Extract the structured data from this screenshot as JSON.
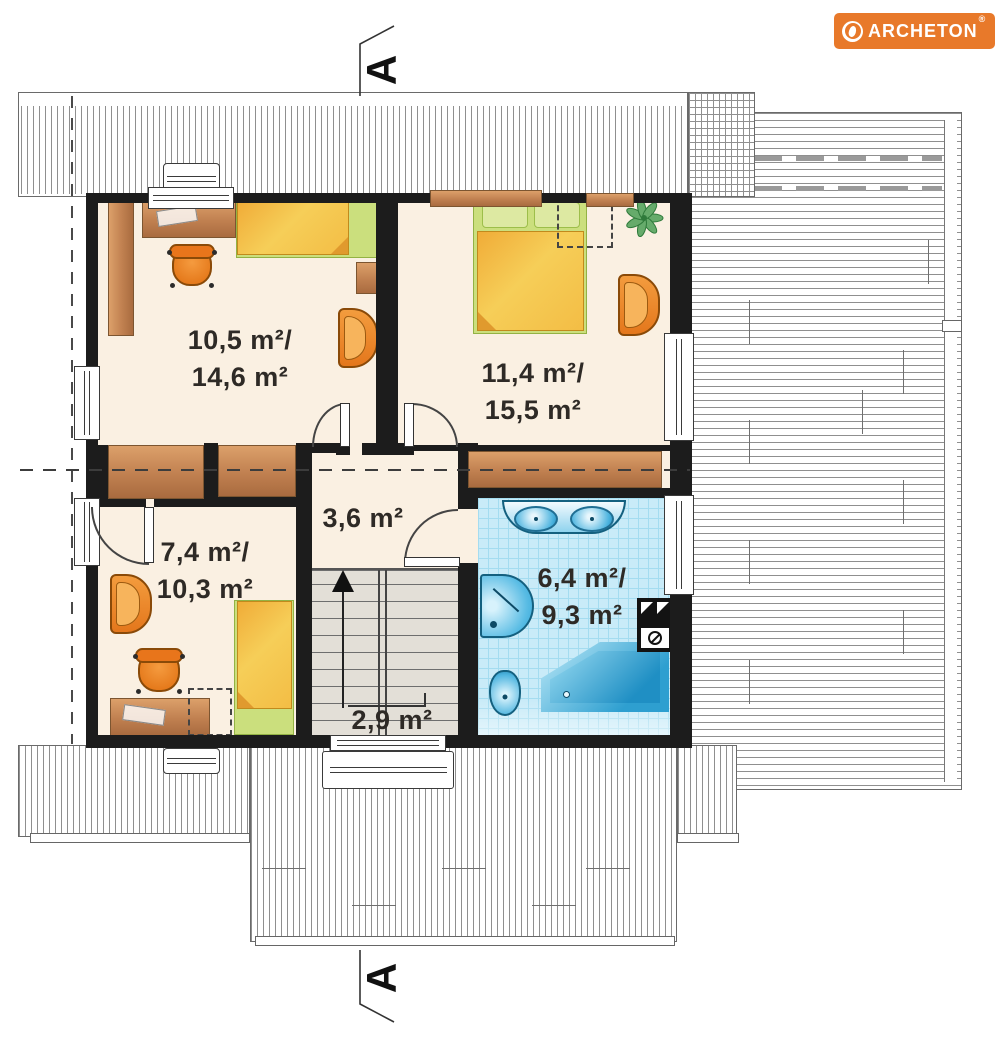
{
  "logo": {
    "brand": "ARCHETON",
    "registered": "®",
    "bg_color": "#E8792A"
  },
  "section_markers": {
    "top": "A",
    "bottom": "A"
  },
  "plan": {
    "rooms": [
      {
        "name": "bedroom-top-left",
        "label_line1": "10,5 m²/",
        "label_line2": "14,6 m²"
      },
      {
        "name": "bedroom-top-right",
        "label_line1": "11,4 m²/",
        "label_line2": "15,5 m²"
      },
      {
        "name": "bedroom-bottom-left",
        "label_line1": "7,4 m²/",
        "label_line2": "10,3 m²"
      },
      {
        "name": "hall",
        "label_line1": "3,6 m²",
        "label_line2": ""
      },
      {
        "name": "bathroom",
        "label_line1": "6,4 m²/",
        "label_line2": "9,3 m²"
      },
      {
        "name": "staircase",
        "label_line1": "2,9 m²",
        "label_line2": ""
      }
    ],
    "colors": {
      "floor_cream": "#FAF0E2",
      "wall_black": "#1C1C1C",
      "bathroom_tile_blue": "#C9EBF8",
      "fixture_blue": "#2EA3D6",
      "furniture_orange": "#E8761B",
      "wood_brown": "#C98B57",
      "bed_yellow": "#F5C453",
      "textile_green": "#CBDF7D",
      "stairs_gray": "#E3DFD7",
      "brand_orange": "#E8792A"
    }
  }
}
